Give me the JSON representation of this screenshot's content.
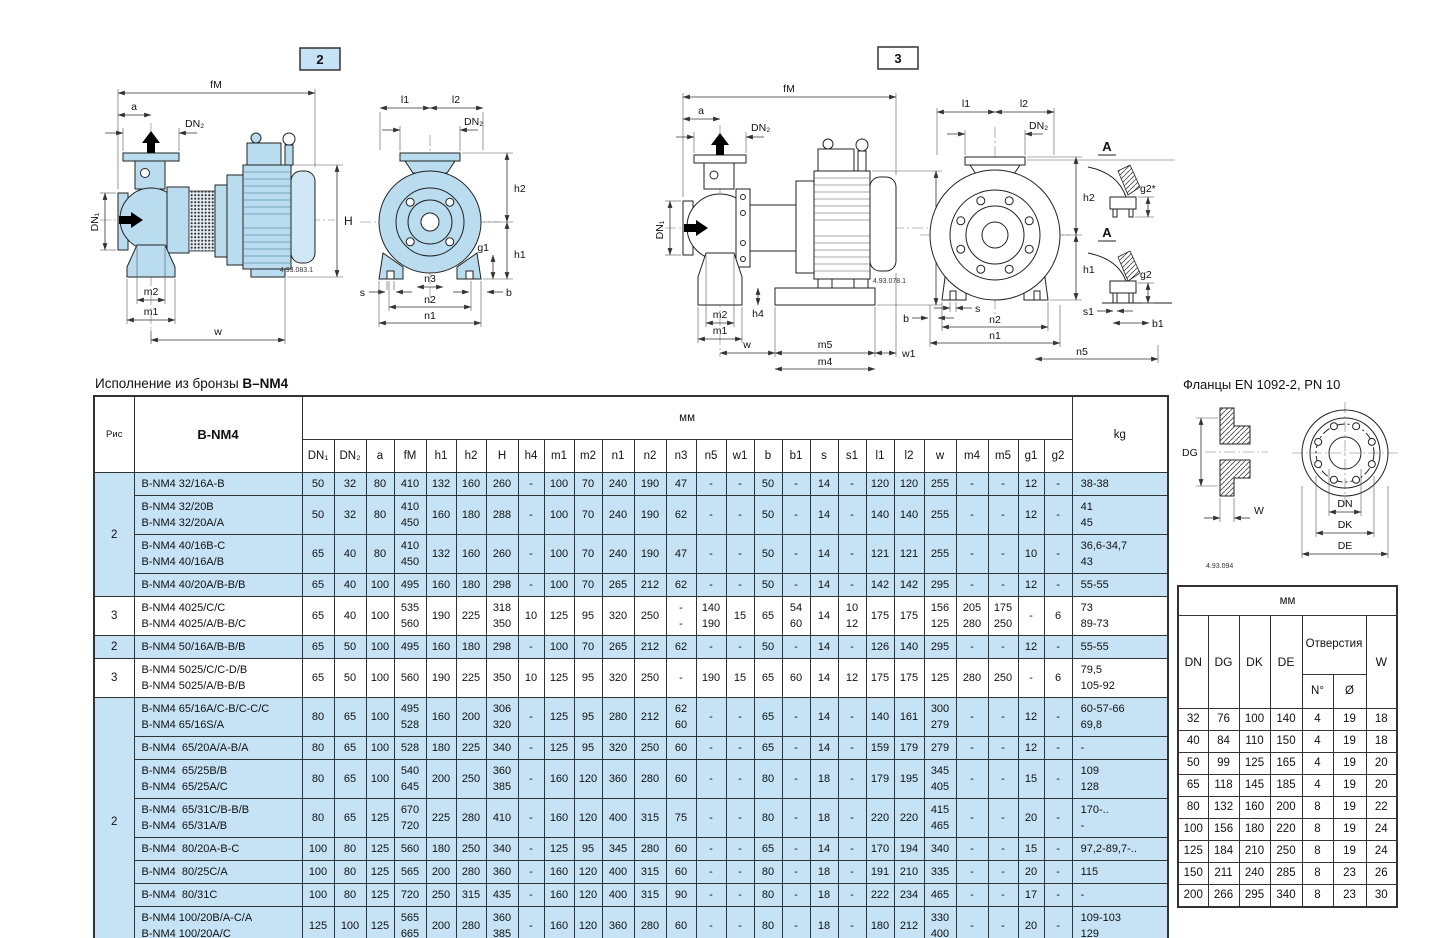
{
  "page": {
    "left_title_prefix": "Исполнение из бронзы ",
    "left_title_model": "B–NM4",
    "right_title": "Фланцы EN 1092-2, PN 10"
  },
  "figures": {
    "fig2_label": "2",
    "fig3_label": "3",
    "fig2_drawing_no": "4.93.083.1",
    "fig3_drawing_no": "4.93.078.1",
    "flange_drawing_no": "4.93.094",
    "dims": {
      "fM": "fM",
      "a": "a",
      "DN1": "DN₁",
      "DN2": "DN₂",
      "H": "H",
      "h1": "h1",
      "h2": "h2",
      "h4": "h4",
      "g1": "g1",
      "g2": "g2",
      "g2s": "g2*",
      "m1": "m1",
      "m2": "m2",
      "m4": "m4",
      "m5": "m5",
      "n1": "n1",
      "n2": "n2",
      "n3": "n3",
      "n5": "n5",
      "w": "w",
      "w1": "w1",
      "b": "b",
      "b1": "b1",
      "s": "s",
      "s1": "s1",
      "l1": "l1",
      "l2": "l2",
      "A": "A",
      "DG": "DG",
      "W": "W",
      "DN": "DN",
      "DK": "DK",
      "DE": "DE"
    }
  },
  "main_table": {
    "col_fig": "Рис",
    "col_model": "B-NM4",
    "unit": "мм",
    "col_kg": "kg",
    "columns": [
      "DN₁",
      "DN₂",
      "a",
      "fM",
      "h1",
      "h2",
      "H",
      "h4",
      "m1",
      "m2",
      "n1",
      "n2",
      "n3",
      "n5",
      "w1",
      "b",
      "b1",
      "s",
      "s1",
      "l1",
      "l2",
      "w",
      "m4",
      "m5",
      "g1",
      "g2"
    ],
    "rows": [
      {
        "fig": "2",
        "figspan": 4,
        "shade": true,
        "model": "B-NM4 32/16A-B",
        "values": [
          "50",
          "32",
          "80",
          "410",
          "132",
          "160",
          "260",
          "-",
          "100",
          "70",
          "240",
          "190",
          "47",
          "-",
          "-",
          "50",
          "-",
          "14",
          "-",
          "120",
          "120",
          "255",
          "-",
          "-",
          "12",
          "-"
        ],
        "kg": "38-38"
      },
      {
        "shade": true,
        "model": "B-NM4 32/20B\nB-NM4 32/20A/A",
        "values": [
          "50",
          "32",
          "80",
          "410\n450",
          "160",
          "180",
          "288",
          "-",
          "100",
          "70",
          "240",
          "190",
          "62",
          "-",
          "-",
          "50",
          "-",
          "14",
          "-",
          "140",
          "140",
          "255",
          "-",
          "-",
          "12",
          "-"
        ],
        "kg": "41\n45"
      },
      {
        "shade": true,
        "model": "B-NM4 40/16B-C\nB-NM4 40/16A/B",
        "values": [
          "65",
          "40",
          "80",
          "410\n450",
          "132",
          "160",
          "260",
          "-",
          "100",
          "70",
          "240",
          "190",
          "47",
          "-",
          "-",
          "50",
          "-",
          "14",
          "-",
          "121",
          "121",
          "255",
          "-",
          "-",
          "10",
          "-"
        ],
        "kg": "36,6-34,7\n43"
      },
      {
        "shade": true,
        "model": "B-NM4 40/20A/B-B/B",
        "values": [
          "65",
          "40",
          "100",
          "495",
          "160",
          "180",
          "298",
          "-",
          "100",
          "70",
          "265",
          "212",
          "62",
          "-",
          "-",
          "50",
          "-",
          "14",
          "-",
          "142",
          "142",
          "295",
          "-",
          "-",
          "12",
          "-"
        ],
        "kg": "55-55"
      },
      {
        "fig": "3",
        "figspan": 1,
        "shade": false,
        "model": "B-NM4 4025/C/C\nB-NM4 4025/A/B-B/C",
        "values": [
          "65",
          "40",
          "100",
          "535\n560",
          "190",
          "225",
          "318\n350",
          "10",
          "125",
          "95",
          "320",
          "250",
          "-\n-",
          "140\n190",
          "15",
          "65",
          "54\n60",
          "14",
          "10\n12",
          "175",
          "175",
          "156\n125",
          "205\n280",
          "175\n250",
          "-",
          "6"
        ],
        "kg": "73\n89-73"
      },
      {
        "fig": "2",
        "figspan": 1,
        "shade": true,
        "model": "B-NM4 50/16A/B-B/B",
        "values": [
          "65",
          "50",
          "100",
          "495",
          "160",
          "180",
          "298",
          "-",
          "100",
          "70",
          "265",
          "212",
          "62",
          "-",
          "-",
          "50",
          "-",
          "14",
          "-",
          "126",
          "140",
          "295",
          "-",
          "-",
          "12",
          "-"
        ],
        "kg": "55-55"
      },
      {
        "fig": "3",
        "figspan": 1,
        "shade": false,
        "model": "B-NM4 5025/C/C-D/B\nB-NM4 5025/A/B-B/B",
        "values": [
          "65",
          "50",
          "100",
          "560",
          "190",
          "225",
          "350",
          "10",
          "125",
          "95",
          "320",
          "250",
          "-",
          "190",
          "15",
          "65",
          "60",
          "14",
          "12",
          "175",
          "175",
          "125",
          "280",
          "250",
          "-",
          "6"
        ],
        "kg": "79,5\n105-92"
      },
      {
        "fig": "2",
        "figspan": 8,
        "shade": true,
        "model": "B-NM4 65/16A/C-B/C-C/C\nB-NM4 65/16S/A",
        "values": [
          "80",
          "65",
          "100",
          "495\n528",
          "160",
          "200",
          "306\n320",
          "-",
          "125",
          "95",
          "280",
          "212",
          "62\n60",
          "-",
          "-",
          "65",
          "-",
          "14",
          "-",
          "140",
          "161",
          "300\n279",
          "-",
          "-",
          "12",
          "-"
        ],
        "kg": "60-57-66\n69,8"
      },
      {
        "shade": true,
        "model": "B-NM4  65/20A/A-B/A",
        "values": [
          "80",
          "65",
          "100",
          "528",
          "180",
          "225",
          "340",
          "-",
          "125",
          "95",
          "320",
          "250",
          "60",
          "-",
          "-",
          "65",
          "-",
          "14",
          "-",
          "159",
          "179",
          "279",
          "-",
          "-",
          "12",
          "-"
        ],
        "kg": "-"
      },
      {
        "shade": true,
        "model": "B-NM4  65/25B/B\nB-NM4  65/25A/C",
        "values": [
          "80",
          "65",
          "100",
          "540\n645",
          "200",
          "250",
          "360\n385",
          "-",
          "160",
          "120",
          "360",
          "280",
          "60",
          "-",
          "-",
          "80",
          "-",
          "18",
          "-",
          "179",
          "195",
          "345\n405",
          "-",
          "-",
          "15",
          "-"
        ],
        "kg": "109\n128"
      },
      {
        "shade": true,
        "model": "B-NM4  65/31C/B-B/B\nB-NM4  65/31A/B",
        "values": [
          "80",
          "65",
          "125",
          "670\n720",
          "225",
          "280",
          "410",
          "-",
          "160",
          "120",
          "400",
          "315",
          "75",
          "-",
          "-",
          "80",
          "-",
          "18",
          "-",
          "220",
          "220",
          "415\n465",
          "-",
          "-",
          "20",
          "-"
        ],
        "kg": "170-..\n-"
      },
      {
        "shade": true,
        "model": "B-NM4  80/20A-B-C",
        "values": [
          "100",
          "80",
          "125",
          "560",
          "180",
          "250",
          "340",
          "-",
          "125",
          "95",
          "345",
          "280",
          "60",
          "-",
          "-",
          "65",
          "-",
          "14",
          "-",
          "170",
          "194",
          "340",
          "-",
          "-",
          "15",
          "-"
        ],
        "kg": "97,2-89,7-.."
      },
      {
        "shade": true,
        "model": "B-NM4  80/25C/A",
        "values": [
          "100",
          "80",
          "125",
          "565",
          "200",
          "280",
          "360",
          "-",
          "160",
          "120",
          "400",
          "315",
          "60",
          "-",
          "-",
          "80",
          "-",
          "18",
          "-",
          "191",
          "210",
          "335",
          "-",
          "-",
          "20",
          "-"
        ],
        "kg": "115"
      },
      {
        "shade": true,
        "model": "B-NM4  80/31C",
        "values": [
          "100",
          "80",
          "125",
          "720",
          "250",
          "315",
          "435",
          "-",
          "160",
          "120",
          "400",
          "315",
          "90",
          "-",
          "-",
          "80",
          "-",
          "18",
          "-",
          "222",
          "234",
          "465",
          "-",
          "-",
          "17",
          "-"
        ],
        "kg": "-"
      },
      {
        "shade": true,
        "model": "B-NM4 100/20B/A-C/A\nB-NM4 100/20A/C",
        "values": [
          "125",
          "100",
          "125",
          "565\n665",
          "200",
          "280",
          "360\n385",
          "-",
          "160",
          "120",
          "360",
          "280",
          "60",
          "-",
          "-",
          "80",
          "-",
          "18",
          "-",
          "180",
          "212",
          "330\n400",
          "-",
          "-",
          "20",
          "-"
        ],
        "kg": "109-103\n129"
      }
    ]
  },
  "flange_table": {
    "unit": "мм",
    "columns": [
      "DN",
      "DG",
      "DK",
      "DE"
    ],
    "holes_label": "Отверстия",
    "holes_sub": [
      "N°",
      "Ø"
    ],
    "col_w": "W",
    "rows": [
      [
        "32",
        "76",
        "100",
        "140",
        "4",
        "19",
        "18"
      ],
      [
        "40",
        "84",
        "110",
        "150",
        "4",
        "19",
        "18"
      ],
      [
        "50",
        "99",
        "125",
        "165",
        "4",
        "19",
        "20"
      ],
      [
        "65",
        "118",
        "145",
        "185",
        "4",
        "19",
        "20"
      ],
      [
        "80",
        "132",
        "160",
        "200",
        "8",
        "19",
        "22"
      ],
      [
        "100",
        "156",
        "180",
        "220",
        "8",
        "19",
        "24"
      ],
      [
        "125",
        "184",
        "210",
        "250",
        "8",
        "19",
        "24"
      ],
      [
        "150",
        "211",
        "240",
        "285",
        "8",
        "23",
        "26"
      ],
      [
        "200",
        "266",
        "295",
        "340",
        "8",
        "23",
        "30"
      ]
    ]
  }
}
